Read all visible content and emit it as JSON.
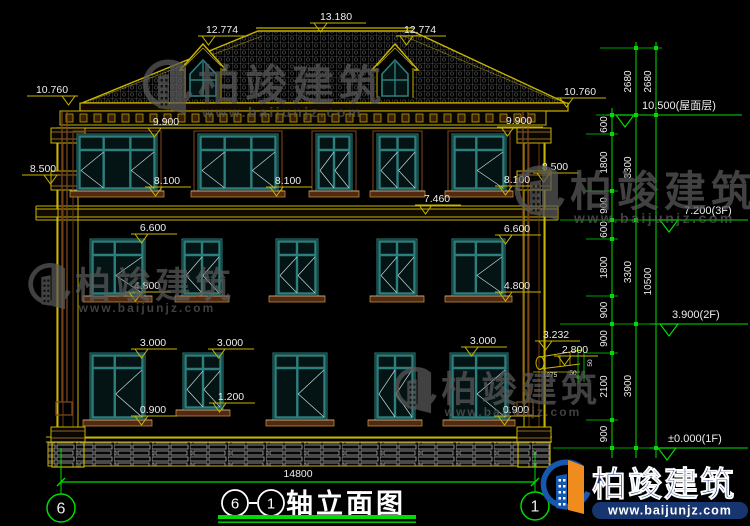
{
  "colors": {
    "bg": "#000000",
    "cad_yellow": "#c9b400",
    "cad_green": "#00dc00",
    "teal": "#2d7f7d",
    "brown": "#6e3d14",
    "brown_light": "#b98a3a",
    "white": "#ededed",
    "watermark_gray": "#5a5a5a",
    "brand_blue": "#1658b0",
    "brand_navy": "#17356e",
    "brand_orange": "#f08c1e"
  },
  "facade_labels": [
    {
      "text": "13.180",
      "cx": 336,
      "y": 20,
      "x1": 310,
      "x2": 366,
      "tri": "left"
    },
    {
      "text": "12.774",
      "cx": 222,
      "y": 33,
      "x1": 198,
      "x2": 248,
      "tri": "left"
    },
    {
      "text": "12.774",
      "cx": 420,
      "y": 33,
      "x1": 396,
      "x2": 446,
      "tri": "left"
    },
    {
      "text": "10.760",
      "cx": 52,
      "y": 93,
      "x1": 27,
      "x2": 78,
      "tri": "right"
    },
    {
      "text": "10.760",
      "cx": 580,
      "y": 95,
      "x1": 556,
      "x2": 606,
      "tri": "left"
    },
    {
      "text": "9.900",
      "cx": 166,
      "y": 125,
      "x1": 144,
      "x2": 190,
      "tri": "left"
    },
    {
      "text": "9.900",
      "cx": 519,
      "y": 124,
      "x1": 497,
      "x2": 543,
      "tri": "left"
    },
    {
      "text": "8.500",
      "cx": 43,
      "y": 172,
      "x1": 22,
      "x2": 60,
      "tri": "right"
    },
    {
      "text": "8.500",
      "cx": 555,
      "y": 170,
      "x1": 533,
      "x2": 579,
      "tri": "left"
    },
    {
      "text": "8.100",
      "cx": 167,
      "y": 184,
      "x1": 145,
      "x2": 191,
      "tri": "left"
    },
    {
      "text": "8.100",
      "cx": 288,
      "y": 184,
      "x1": 266,
      "x2": 312,
      "tri": "left"
    },
    {
      "text": "8.100",
      "cx": 517,
      "y": 183,
      "x1": 495,
      "x2": 541,
      "tri": "left"
    },
    {
      "text": "7.460",
      "cx": 437,
      "y": 202,
      "x1": 415,
      "x2": 461,
      "tri": "left"
    },
    {
      "text": "6.600",
      "cx": 153,
      "y": 231,
      "x1": 131,
      "x2": 177,
      "tri": "left"
    },
    {
      "text": "6.600",
      "cx": 517,
      "y": 232,
      "x1": 495,
      "x2": 541,
      "tri": "left"
    },
    {
      "text": "4.800",
      "cx": 147,
      "y": 289,
      "x1": 125,
      "x2": 171,
      "tri": "left"
    },
    {
      "text": "4.800",
      "cx": 517,
      "y": 289,
      "x1": 495,
      "x2": 541,
      "tri": "left"
    },
    {
      "text": "3.000",
      "cx": 153,
      "y": 346,
      "x1": 131,
      "x2": 177,
      "tri": "left"
    },
    {
      "text": "3.000",
      "cx": 230,
      "y": 346,
      "x1": 208,
      "x2": 254,
      "tri": "left"
    },
    {
      "text": "3.000",
      "cx": 483,
      "y": 344,
      "x1": 461,
      "x2": 507,
      "tri": "left"
    },
    {
      "text": "3.232",
      "cx": 556,
      "y": 338,
      "x1": 535,
      "x2": 580,
      "tri": "left"
    },
    {
      "text": "2.800",
      "cx": 575,
      "y": 353,
      "x1": 554,
      "x2": 598,
      "tri": "left"
    },
    {
      "text": "1.200",
      "cx": 231,
      "y": 400,
      "x1": 209,
      "x2": 255,
      "tri": "left"
    },
    {
      "text": "0.900",
      "cx": 153,
      "y": 413,
      "x1": 131,
      "x2": 177,
      "tri": "left"
    },
    {
      "text": "0.900",
      "cx": 516,
      "y": 413,
      "x1": 494,
      "x2": 540,
      "tri": "left"
    }
  ],
  "chain_columns": [
    {
      "x": 612,
      "top": 108,
      "bottom": 458,
      "nodes": [
        115,
        134,
        191,
        220,
        239,
        296,
        324,
        353,
        420,
        448
      ],
      "labels": [
        "600",
        "1800",
        "900",
        "600",
        "1800",
        "900",
        "900",
        "2100",
        "900"
      ]
    },
    {
      "x": 636,
      "top": 42,
      "bottom": 458,
      "nodes": [
        48,
        115,
        220,
        324,
        448
      ],
      "labels": [
        "2680",
        "3300",
        "3300",
        "3900"
      ]
    },
    {
      "x": 656,
      "top": 42,
      "bottom": 458,
      "nodes": [
        48,
        115,
        448
      ],
      "labels": [
        "2680",
        "10500"
      ]
    }
  ],
  "level_markers": [
    {
      "text": "10.500(屋面层)",
      "y": 115,
      "x1": 606,
      "x2": 742,
      "tri_x": 616,
      "text_x": 642
    },
    {
      "text": "7.200(3F)",
      "y": 220,
      "x1": 644,
      "x2": 748,
      "tri_x": 660,
      "text_x": 684
    },
    {
      "text": "3.900(2F)",
      "y": 324,
      "x1": 650,
      "x2": 748,
      "tri_x": 660,
      "text_x": 672
    },
    {
      "text": "±0.000(1F)",
      "y": 448,
      "x1": 650,
      "x2": 748,
      "tri_x": 658,
      "text_x": 668
    }
  ],
  "small_dims": [
    {
      "text": "1275",
      "x": 550,
      "y": 377,
      "rot": 0
    },
    {
      "text": "50",
      "x": 573,
      "y": 375,
      "rot": 0
    },
    {
      "text": "50",
      "x": 592,
      "y": 363,
      "rot": -90
    }
  ],
  "overall_dim": {
    "text": "14800",
    "y": 482,
    "x1": 61,
    "x2": 535,
    "label_cx": 298,
    "label_y": 477
  },
  "axis_bubbles": [
    {
      "label": "6",
      "cx": 61,
      "cy": 508,
      "line_top": 448
    },
    {
      "label": "1",
      "cx": 535,
      "cy": 506,
      "line_top": 452
    }
  ],
  "title": {
    "axis_a": "6",
    "axis_b": "1",
    "text": "轴立面图",
    "cx_a": 235,
    "cx_b": 271,
    "cy": 503,
    "text_x": 286,
    "text_y": 513,
    "ul_x1": 218,
    "ul_x2": 416
  },
  "watermarks": [
    {
      "x": 140,
      "y": 56,
      "s": 1.0,
      "text": "柏竣建筑",
      "url": "www.baijunjz.com"
    },
    {
      "x": 512,
      "y": 162,
      "s": 1.0,
      "text": "柏竣建筑",
      "url": "www.baijunjz.com"
    },
    {
      "x": 26,
      "y": 260,
      "s": 0.85,
      "text": "柏竣建筑",
      "url": "www.baijunjz.com"
    },
    {
      "x": 392,
      "y": 364,
      "s": 0.85,
      "text": "柏竣建筑",
      "url": "www.baijunjz.com"
    }
  ],
  "brand_logo": {
    "x": 538,
    "y": 456,
    "text": "柏竣建筑",
    "url": "www.baijunjz.com"
  }
}
